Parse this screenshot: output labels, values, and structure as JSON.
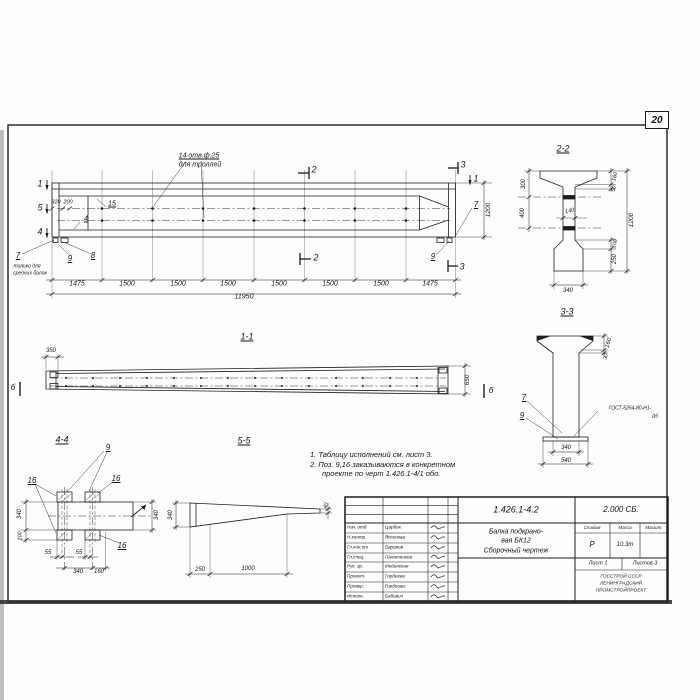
{
  "page": {
    "number": "20"
  },
  "notes": {
    "line1": "1. Таблицу исполнений см. лист 3.",
    "line2": "2. Поз. 9,16 заказываются в конкретном",
    "line3": "проекте по черт 1.426.1-4/1 обо."
  },
  "title_block": {
    "doc_number": "1.426.1-4.2",
    "series": "2.000 СБ.",
    "title_line1": "Балка подкрано-",
    "title_line2": "вая БК12",
    "title_line3": "Сборочный чертеж",
    "stage_header": "Стадия",
    "mass_header": "Масса",
    "scale_header": "Масшт.",
    "stage_value": "Р",
    "mass_value": "10,3т",
    "sheet_label": "Лист 1",
    "sheets_label": "Листов 3",
    "org_line1": "ГОССТРОЙ СССР",
    "org_line2": "ЛЕНИНГРАДСКИЙ",
    "org_line3": "ПРОМСТРОЙПРОЕКТ",
    "staff": [
      {
        "role": "Нач. отд",
        "name": "Царбак"
      },
      {
        "role": "Н.контр.",
        "name": "Яксенова"
      },
      {
        "role": "Гл.кон.от",
        "name": "Баранов"
      },
      {
        "role": "Гл.спец.",
        "name": "Палатников"
      },
      {
        "role": "Рук. гр.",
        "name": "Мединская"
      },
      {
        "role": "Проект.",
        "name": "Гордеева"
      },
      {
        "role": "Провер.",
        "name": "Гордеева"
      },
      {
        "role": "Исполн.",
        "name": "Бабович"
      }
    ]
  },
  "annotations": [
    {
      "t": "14 отв.ф.25",
      "x": 199,
      "y": 156,
      "s": 7,
      "u": true,
      "n": "holes-callout"
    },
    {
      "t": "для троллей",
      "x": 200,
      "y": 165,
      "s": 7,
      "n": "holes-callout"
    },
    {
      "t": "2",
      "x": 314,
      "y": 170,
      "s": 9,
      "n": "section-mark-2"
    },
    {
      "t": "2",
      "x": 316,
      "y": 258,
      "s": 9,
      "n": "section-mark-2"
    },
    {
      "t": "3",
      "x": 463,
      "y": 165,
      "s": 9,
      "n": "section-mark-3"
    },
    {
      "t": "3",
      "x": 462,
      "y": 267,
      "s": 9,
      "n": "section-mark-3"
    },
    {
      "t": "1",
      "x": 40,
      "y": 184,
      "s": 9,
      "n": "section-mark-1"
    },
    {
      "t": "5",
      "x": 40,
      "y": 208,
      "s": 9,
      "n": "section-mark-5"
    },
    {
      "t": "4",
      "x": 40,
      "y": 232,
      "s": 9,
      "n": "section-mark-4"
    },
    {
      "t": "1",
      "x": 476,
      "y": 179,
      "s": 9,
      "n": "section-mark-1"
    },
    {
      "t": "320",
      "x": 56,
      "y": 203,
      "s": 5.5
    },
    {
      "t": "200",
      "x": 68,
      "y": 203,
      "s": 5.5
    },
    {
      "t": "15",
      "x": 112,
      "y": 204,
      "s": 7,
      "u": true,
      "n": "pos-label-15"
    },
    {
      "t": "4",
      "x": 86,
      "y": 219,
      "s": 7,
      "u": true,
      "n": "pos-label-4"
    },
    {
      "t": "7",
      "x": 18,
      "y": 256,
      "s": 8,
      "u": true,
      "n": "pos-label-7"
    },
    {
      "t": "только для",
      "x": 27,
      "y": 267,
      "s": 5
    },
    {
      "t": "средних балок",
      "x": 30,
      "y": 274,
      "s": 5
    },
    {
      "t": "9",
      "x": 70,
      "y": 259,
      "s": 8,
      "u": true,
      "n": "pos-label-9"
    },
    {
      "t": "8",
      "x": 93,
      "y": 256,
      "s": 8,
      "u": true,
      "n": "pos-label-8"
    },
    {
      "t": "7",
      "x": 476,
      "y": 205,
      "s": 8,
      "u": true,
      "n": "pos-label-7"
    },
    {
      "t": "9",
      "x": 433,
      "y": 257,
      "s": 8,
      "u": true,
      "n": "pos-label-9"
    },
    {
      "t": "1200",
      "x": 489,
      "y": 210,
      "r": -90,
      "s": 6.5
    },
    {
      "t": "1475",
      "x": 77,
      "y": 284,
      "s": 7
    },
    {
      "t": "1500",
      "x": 127,
      "y": 284,
      "s": 7
    },
    {
      "t": "1500",
      "x": 178,
      "y": 284,
      "s": 7
    },
    {
      "t": "1500",
      "x": 228,
      "y": 284,
      "s": 7
    },
    {
      "t": "1500",
      "x": 279,
      "y": 284,
      "s": 7
    },
    {
      "t": "1500",
      "x": 330,
      "y": 284,
      "s": 7
    },
    {
      "t": "1500",
      "x": 381,
      "y": 284,
      "s": 7
    },
    {
      "t": "1475",
      "x": 430,
      "y": 284,
      "s": 7
    },
    {
      "t": "11950",
      "x": 244,
      "y": 297,
      "s": 7
    },
    {
      "t": "1-1",
      "x": 247,
      "y": 337,
      "s": 9,
      "u": true,
      "n": "view-title-1-1"
    },
    {
      "t": "350",
      "x": 51,
      "y": 351,
      "s": 6
    },
    {
      "t": "650",
      "x": 468,
      "y": 380,
      "r": -90,
      "s": 6.5
    },
    {
      "t": "б",
      "x": 13,
      "y": 388,
      "s": 8,
      "n": "section-mark-b"
    },
    {
      "t": "б",
      "x": 491,
      "y": 391,
      "s": 8,
      "n": "section-mark-b"
    },
    {
      "t": "4-4",
      "x": 62,
      "y": 440,
      "s": 9,
      "u": true,
      "n": "view-title-4-4"
    },
    {
      "t": "9",
      "x": 108,
      "y": 448,
      "s": 8,
      "u": true,
      "n": "pos-label-9"
    },
    {
      "t": "16",
      "x": 32,
      "y": 481,
      "s": 8,
      "u": true,
      "n": "pos-label-16"
    },
    {
      "t": "16",
      "x": 116,
      "y": 479,
      "s": 8,
      "u": true,
      "n": "pos-label-16"
    },
    {
      "t": "16",
      "x": 122,
      "y": 546,
      "s": 8,
      "u": true,
      "n": "pos-label-16"
    },
    {
      "t": "340",
      "x": 20,
      "y": 514,
      "r": -90,
      "s": 6
    },
    {
      "t": "100",
      "x": 21,
      "y": 536,
      "r": -90,
      "s": 5.5
    },
    {
      "t": "55",
      "x": 48,
      "y": 553,
      "s": 6
    },
    {
      "t": "55",
      "x": 79,
      "y": 553,
      "s": 6
    },
    {
      "t": "340",
      "x": 78,
      "y": 572,
      "s": 6
    },
    {
      "t": "160",
      "x": 99,
      "y": 572,
      "s": 6
    },
    {
      "t": "340",
      "x": 157,
      "y": 515,
      "r": -90,
      "s": 6
    },
    {
      "t": "5-5",
      "x": 244,
      "y": 441,
      "s": 9,
      "u": true,
      "n": "view-title-5-5"
    },
    {
      "t": "340",
      "x": 171,
      "y": 515,
      "r": -90,
      "s": 6
    },
    {
      "t": "40",
      "x": 327,
      "y": 506,
      "r": -75,
      "s": 5.5
    },
    {
      "t": "250",
      "x": 200,
      "y": 570,
      "s": 6
    },
    {
      "t": "1000",
      "x": 248,
      "y": 569,
      "s": 6
    },
    {
      "t": "2-2",
      "x": 563,
      "y": 149,
      "s": 9,
      "u": true,
      "n": "view-title-2-2"
    },
    {
      "t": "300",
      "x": 524,
      "y": 184,
      "r": -90,
      "s": 6
    },
    {
      "t": "400",
      "x": 523,
      "y": 213,
      "r": -90,
      "s": 6
    },
    {
      "t": "140",
      "x": 570,
      "y": 212,
      "r": -12,
      "s": 5.5
    },
    {
      "t": "160",
      "x": 616,
      "y": 177,
      "r": -75,
      "s": 5.5
    },
    {
      "t": "50",
      "x": 615,
      "y": 189,
      "r": -75,
      "s": 5.5
    },
    {
      "t": "1200",
      "x": 632,
      "y": 220,
      "r": -90,
      "s": 6.5
    },
    {
      "t": "100",
      "x": 616,
      "y": 244,
      "r": -75,
      "s": 5.5
    },
    {
      "t": "250",
      "x": 615,
      "y": 259,
      "r": -90,
      "s": 6
    },
    {
      "t": "340",
      "x": 568,
      "y": 291,
      "s": 6
    },
    {
      "t": "3-3",
      "x": 567,
      "y": 312,
      "s": 9,
      "u": true,
      "n": "view-title-3-3"
    },
    {
      "t": "160",
      "x": 609,
      "y": 343,
      "r": -75,
      "s": 6
    },
    {
      "t": "30",
      "x": 607,
      "y": 357,
      "r": -75,
      "s": 5.5
    },
    {
      "t": "7",
      "x": 524,
      "y": 398,
      "s": 8,
      "u": true,
      "n": "pos-label-7"
    },
    {
      "t": "9",
      "x": 522,
      "y": 416,
      "s": 8,
      "u": true,
      "n": "pos-label-9"
    },
    {
      "t": "ГОСТ-5264-80-Н1-",
      "x": 630,
      "y": 409,
      "s": 5,
      "n": "weld-spec"
    },
    {
      "t": "Δ6",
      "x": 655,
      "y": 417,
      "s": 5,
      "n": "weld-spec"
    },
    {
      "t": "340",
      "x": 566,
      "y": 448,
      "s": 6
    },
    {
      "t": "540",
      "x": 566,
      "y": 461,
      "s": 6
    }
  ]
}
